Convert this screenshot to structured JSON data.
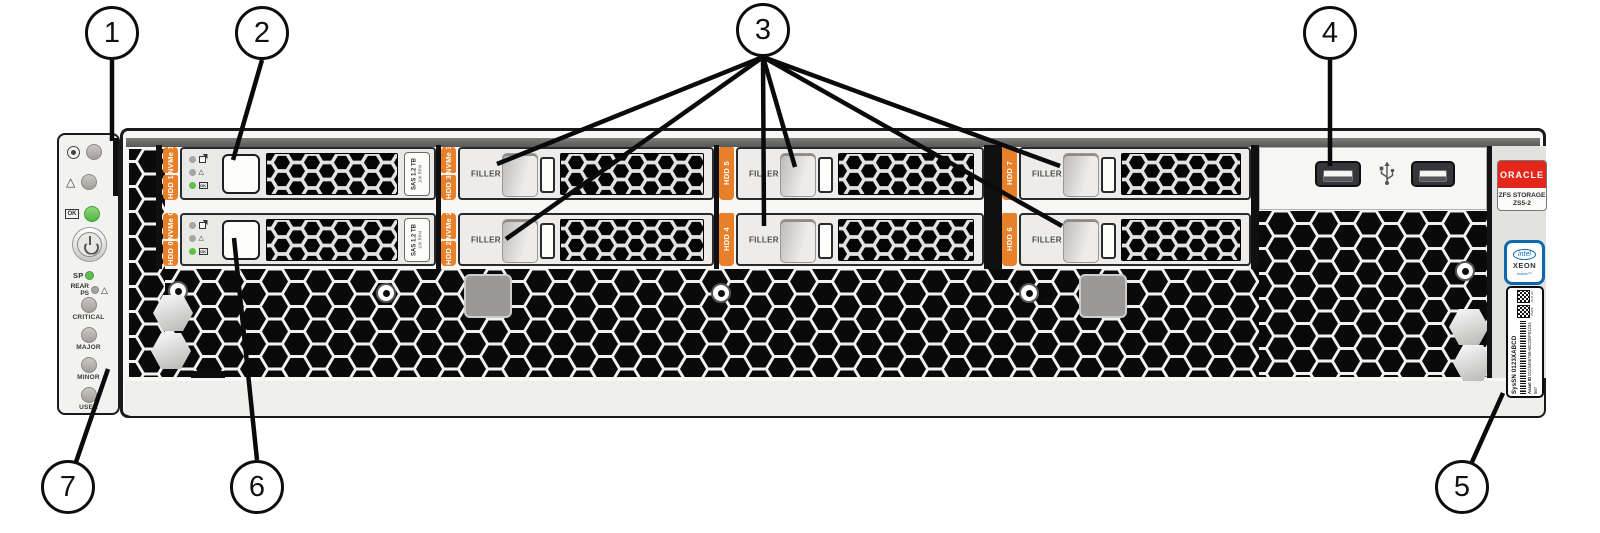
{
  "callouts": [
    {
      "number": "1"
    },
    {
      "number": "2"
    },
    {
      "number": "3"
    },
    {
      "number": "4"
    },
    {
      "number": "5"
    },
    {
      "number": "6"
    },
    {
      "number": "7"
    }
  ],
  "icons": {
    "ok": "OK",
    "fault_triangle": "△",
    "locate": "target-circle",
    "power": "power-symbol",
    "usb": "usb-trident",
    "ready_to_remove": "box-arrow"
  },
  "left_panel": {
    "sp_label": "SP",
    "rear_label": "REAR",
    "ps_label": "PS",
    "alarm_labels": [
      "CRITICAL",
      "MAJOR",
      "MINOR",
      "USER"
    ]
  },
  "bays": {
    "filler_text": "FILLER",
    "disk_label": {
      "interface": "SAS",
      "capacity": "1.2 TB",
      "speed": "10K RPM"
    },
    "columns": [
      {
        "top": {
          "kind": "disk",
          "strip": [
            "NVMe 1",
            "HDD 1"
          ]
        },
        "bottom": {
          "kind": "disk",
          "strip": [
            "NVMe 0",
            "HDD 0"
          ]
        }
      },
      {
        "top": {
          "kind": "filler",
          "strip": [
            "NVMe 3",
            "HDD 3"
          ]
        },
        "bottom": {
          "kind": "filler",
          "strip": [
            "NVMe 2",
            "HDD 2"
          ]
        }
      },
      {
        "top": {
          "kind": "filler",
          "strip": [
            "HDD 5"
          ]
        },
        "bottom": {
          "kind": "filler",
          "strip": [
            "HDD 4"
          ]
        }
      },
      {
        "top": {
          "kind": "filler",
          "strip": [
            "HDD 7"
          ]
        },
        "bottom": {
          "kind": "filler",
          "strip": [
            "HDD 6"
          ]
        }
      }
    ]
  },
  "right_panel": {
    "oracle_logo": "ORACLE",
    "product": "ZFS STORAGE",
    "model": "ZS5-2",
    "intel_badge": {
      "brand": "intel",
      "cpu": "XEON",
      "tagline": "inside™"
    },
    "serial_label": {
      "qr1_caption": "PMRC",
      "qr2_caption": "DoD UII",
      "sys_sn": "SysSN 0123XABCD",
      "asset_id_label": "Asset ID",
      "asset_id": "0123456789ABCDEF01234567"
    }
  },
  "colors": {
    "slot_label_orange": "#e8802a",
    "oracle_red": "#e5261b",
    "intel_blue": "#0c69b0",
    "led_green": "#5fc04d",
    "led_gray": "#aaa49e"
  }
}
